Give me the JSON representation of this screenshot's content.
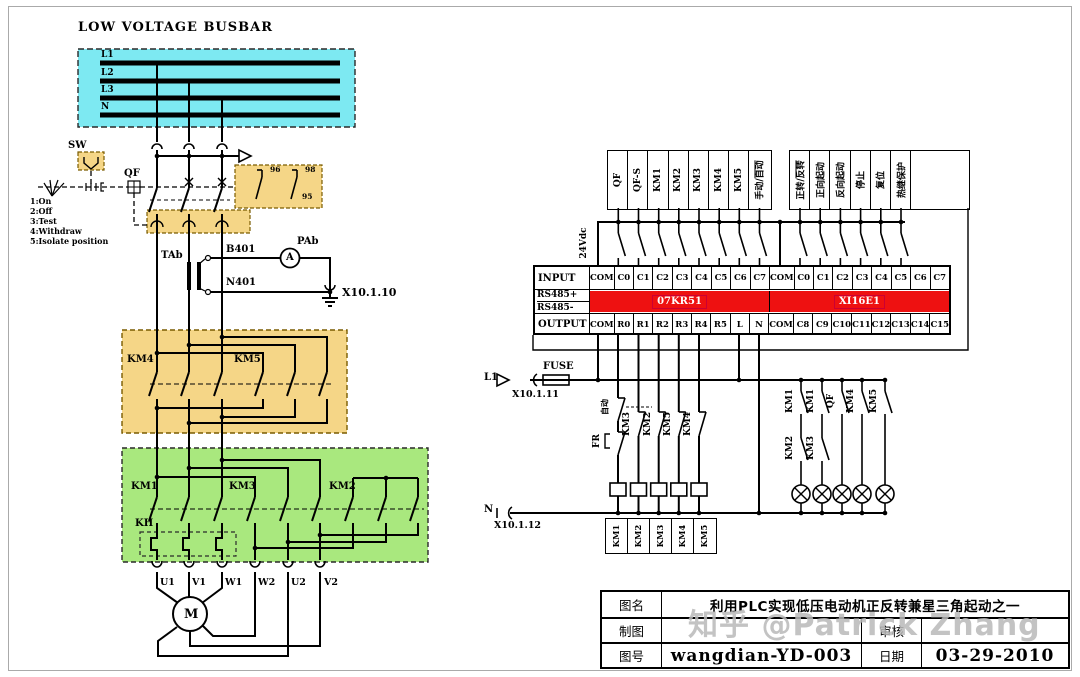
{
  "busbar": {
    "title": "LOW VOLTAGE BUSBAR",
    "lines": [
      "L1",
      "L2",
      "L3",
      "N"
    ]
  },
  "drawout": {
    "sw": "SW",
    "qf": "QF",
    "positions": [
      "1:On",
      "2:Off",
      "3:Test",
      "4:Withdraw",
      "5:Isolate position"
    ],
    "aux": {
      "t96": "96",
      "t98": "98",
      "t95": "95"
    }
  },
  "meter": {
    "ct": "TAb",
    "wire_top": "B401",
    "wire_bottom": "N401",
    "name": "PAb",
    "amp": "A",
    "ground_ref": "X10.1.10"
  },
  "contactors": {
    "km4": "KM4",
    "km5": "KM5",
    "km1": "KM1",
    "km3": "KM3",
    "km2": "KM2",
    "kh": "KH"
  },
  "motor": {
    "symbol": "M",
    "terminals": [
      "U1",
      "V1",
      "W1",
      "W2",
      "U2",
      "V2"
    ]
  },
  "plc": {
    "supply": "24Vdc",
    "left_inputs": [
      {
        "t": "QF"
      },
      {
        "t": "QF-S"
      },
      {
        "t": "KM1"
      },
      {
        "t": "KM2"
      },
      {
        "t": "KM3"
      },
      {
        "t": "KM4"
      },
      {
        "t": "KM5"
      },
      {
        "t": "手动/",
        "o": "自动"
      }
    ],
    "right_inputs": [
      {
        "t": "正转/",
        "o": "反转"
      },
      {
        "t": "正向起动"
      },
      {
        "t": "反向起动"
      },
      {
        "t": "停止"
      },
      {
        "t": "复位"
      },
      {
        "t": "热继保护"
      }
    ],
    "input_label": "INPUT",
    "output_label": "OUTPUT",
    "rs485_plus": "RS485+",
    "rs485_minus": "RS485-",
    "module_left": "07KR51",
    "module_right": "XI16E1",
    "input_cells": [
      "COM",
      "C0",
      "C1",
      "C2",
      "C3",
      "C4",
      "C5",
      "C6",
      "C7",
      "COM",
      "C0",
      "C1",
      "C2",
      "C3",
      "C4",
      "C5",
      "C6",
      "C7"
    ],
    "output_cells": [
      "COM",
      "R0",
      "R1",
      "R2",
      "R3",
      "R4",
      "R5",
      "L",
      "N",
      "COM",
      "C8",
      "C9",
      "C10",
      "C11",
      "C12",
      "C13",
      "C14",
      "C15"
    ]
  },
  "output_circuit": {
    "l1": "L1",
    "fuse": "FUSE",
    "x_l1": "X10.1.11",
    "auto": "自动",
    "fr": "FR",
    "interlocks": [
      "KM3",
      "KM2",
      "KM5",
      "KM4"
    ],
    "coils": [
      "KM1",
      "KM2",
      "KM3",
      "KM4",
      "KM5"
    ],
    "n": "N",
    "x_n": "X10.1.12"
  },
  "lamps": {
    "top": [
      "KM1",
      "KM1",
      "QF",
      "KM4",
      "KM5"
    ],
    "second": [
      "KM2",
      "KM3"
    ]
  },
  "title_block": {
    "name_label": "图名",
    "name_value": "利用PLC实现低压电动机正反转兼星三角起动之一",
    "drafter_label": "制图",
    "checker_label": "审核",
    "number_label": "图号",
    "number_value": "wangdian-YD-003",
    "date_label": "日期",
    "date_value": "03-29-2010"
  },
  "watermark": "知乎 @Patrick Zhang",
  "colors": {
    "busbar_fill": "#7DE9F2",
    "contactor_fill": "#F5D687",
    "star_delta_fill": "#A9E87E",
    "plc_band": "#EE1111"
  }
}
